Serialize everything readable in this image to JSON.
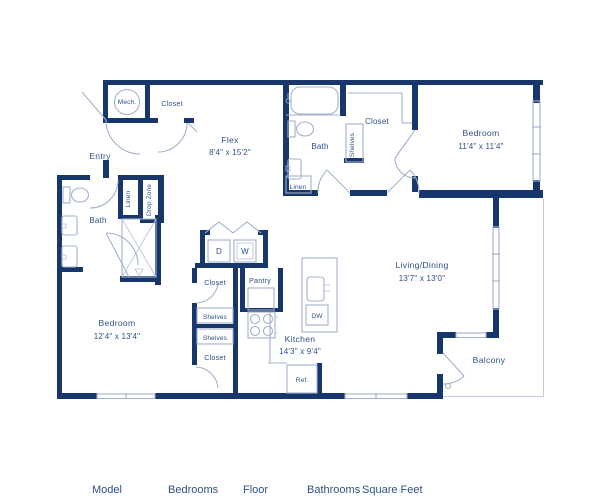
{
  "colors": {
    "wall": "#17366b",
    "thin_line": "#a3b1cc",
    "label": "#2f5089"
  },
  "rooms": {
    "mech": {
      "label": "Mech."
    },
    "entry_closet": {
      "label": "Closet"
    },
    "flex": {
      "label": "Flex",
      "dims": "8'4\" x 15'2\""
    },
    "entry": {
      "label": "Entry"
    },
    "bath_upper": {
      "label": "Bath",
      "linen": "Linen"
    },
    "closet_bedroom1": {
      "label": "Closet",
      "shelves": "Shelves"
    },
    "bedroom1": {
      "label": "Bedroom",
      "dims": "11'4\" x 11'4\""
    },
    "linen_lower": {
      "label": "Linen"
    },
    "drop_zone": {
      "label": "Drop Zone"
    },
    "bath_lower": {
      "label": "Bath"
    },
    "bedroom2": {
      "label": "Bedroom",
      "dims": "12'4\" x 13'4\""
    },
    "closet_b2_top": {
      "label": "Closet",
      "shelves": "Shelves"
    },
    "closet_b2_bottom": {
      "label": "Closet",
      "shelves": "Shelves"
    },
    "laundry": {
      "dryer": "D",
      "washer": "W"
    },
    "pantry": {
      "label": "Pantry"
    },
    "kitchen": {
      "label": "Kitchen",
      "dims": "14'3\" x 9'4\"",
      "dishwasher": "DW",
      "refrigerator": "Ref."
    },
    "living": {
      "label": "Living/Dining",
      "dims": "13'7\" x 13'0\""
    },
    "balcony": {
      "label": "Balcony"
    }
  },
  "footer": {
    "columns": [
      "Model",
      "Bedrooms",
      "Floor",
      "Bathrooms",
      "Square Feet"
    ]
  }
}
